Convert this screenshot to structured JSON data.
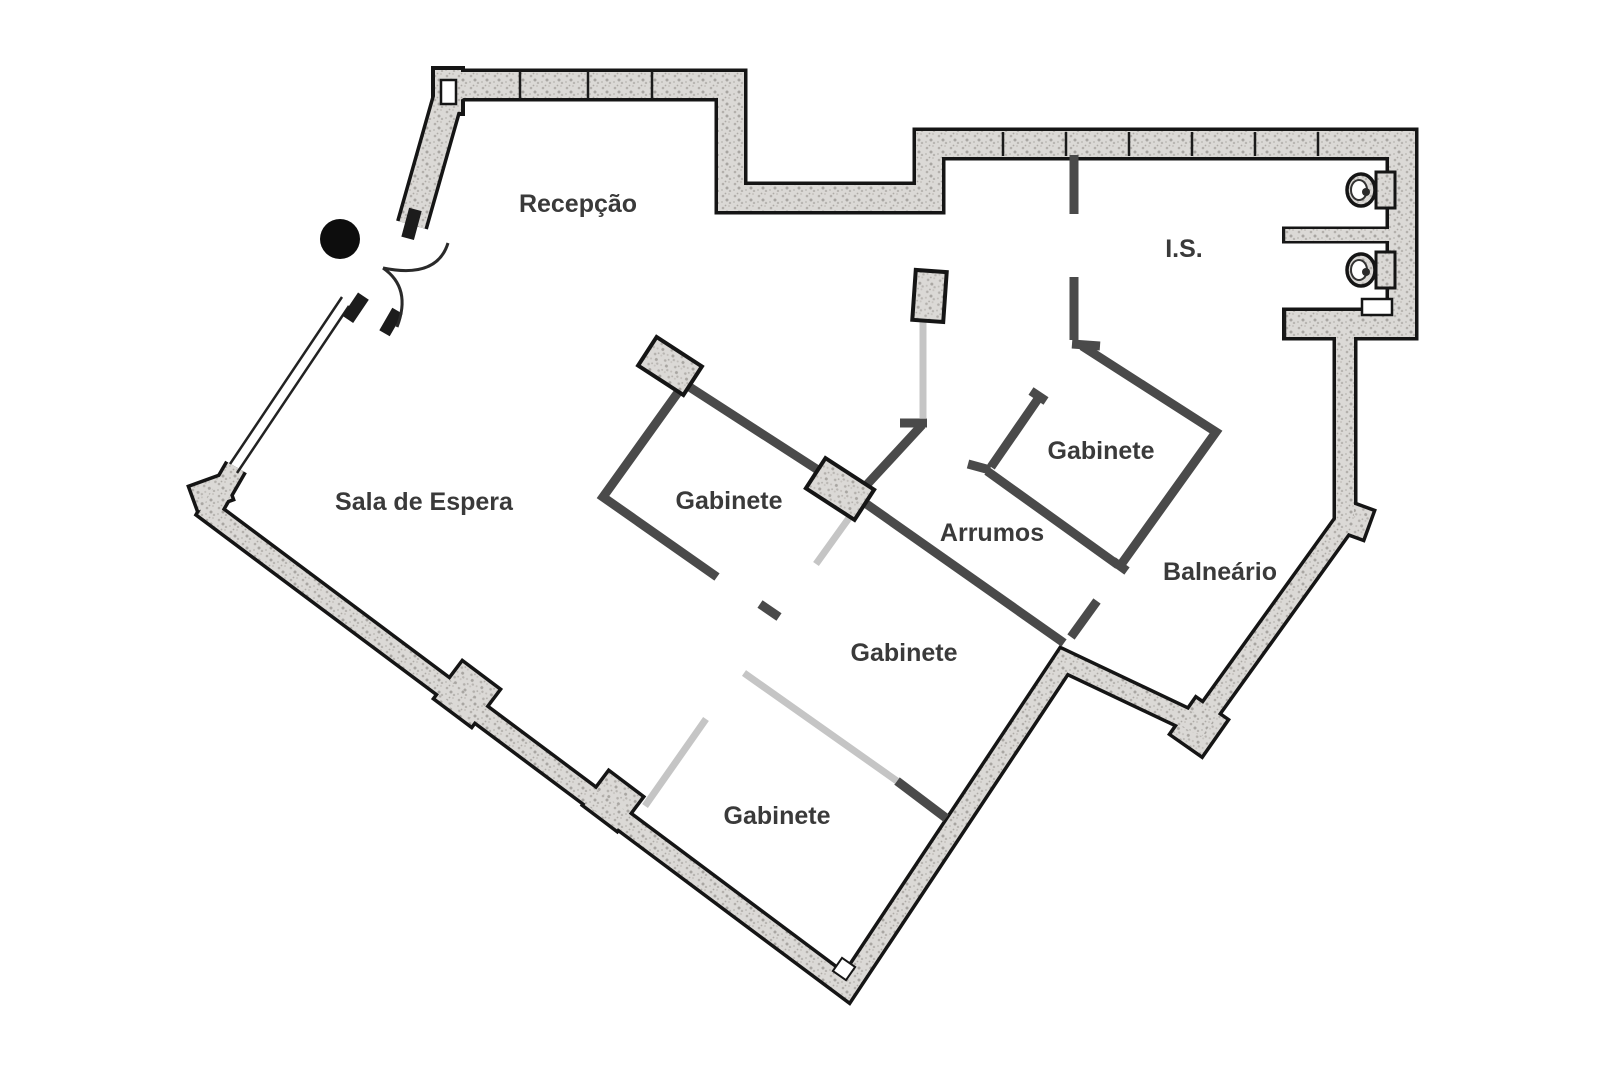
{
  "document": {
    "type": "architectural floor plan",
    "language": "Portuguese"
  },
  "rooms": [
    {
      "id": "recepcao",
      "label": "Recepção"
    },
    {
      "id": "is",
      "label": "I.S."
    },
    {
      "id": "sala-de-espera",
      "label": "Sala de Espera"
    },
    {
      "id": "gabinete-top",
      "label": "Gabinete"
    },
    {
      "id": "gabinete-right",
      "label": "Gabinete"
    },
    {
      "id": "arrumos",
      "label": "Arrumos"
    },
    {
      "id": "balneario",
      "label": "Balneário"
    },
    {
      "id": "gabinete-middle",
      "label": "Gabinete"
    },
    {
      "id": "gabinete-bottom",
      "label": "Gabinete"
    }
  ],
  "fixtures": {
    "toilet_icons": 2,
    "entrance_door_leaves": 2,
    "entrance_pivot_dot": 1,
    "window_segments": 1,
    "columns": 3
  },
  "colors": {
    "background": "#ffffff",
    "wall_fill": "#dbd9d6",
    "wall_edge": "#151515",
    "partition": "#4a4a4a",
    "door_leaf": "#c5c5c5",
    "label": "#3a3a3a",
    "entrance_dot": "#0d0d0d"
  }
}
